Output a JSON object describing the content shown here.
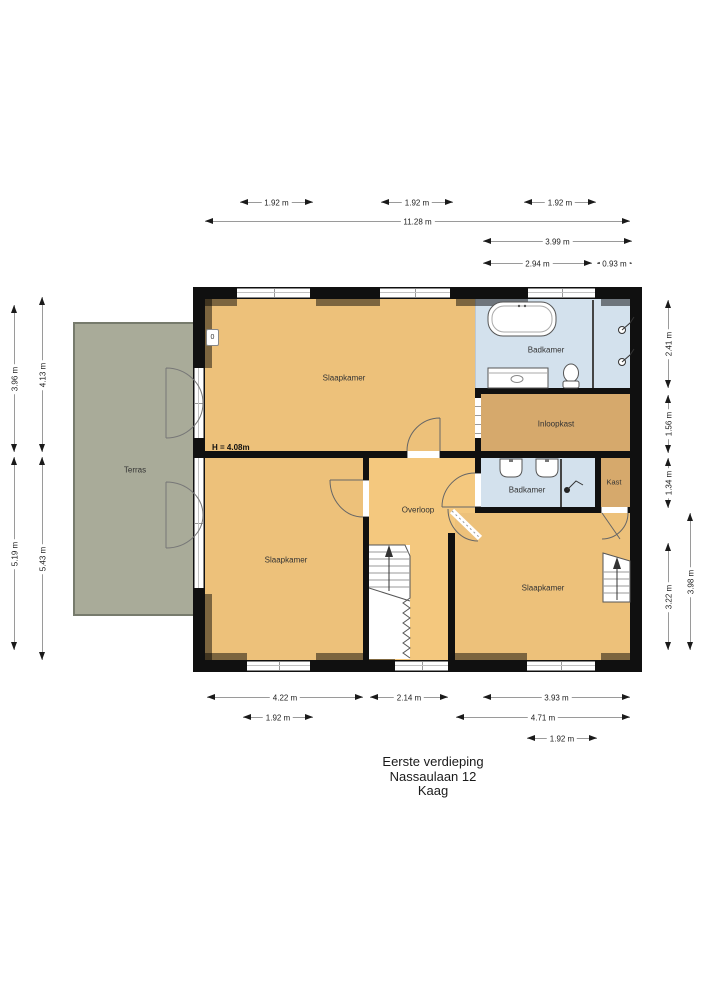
{
  "title": {
    "line1": "Eerste verdieping",
    "line2": "Nassaulaan 12",
    "line3": "Kaag"
  },
  "rooms": {
    "terras": "Terras",
    "slaapkamer_tl": "Slaapkamer",
    "badkamer_top": "Badkamer",
    "inloopkast": "Inloopkast",
    "badkamer_mid": "Badkamer",
    "kast": "Kast",
    "overloop": "Overloop",
    "slaapkamer_bl": "Slaapkamer",
    "slaapkamer_br": "Slaapkamer"
  },
  "annotations": {
    "ceiling_height": "H = 4.08m",
    "marker": "0"
  },
  "dimensions": {
    "top": [
      "1.92 m",
      "1.92 m",
      "1.92 m",
      "11.28 m",
      "3.99 m",
      "2.94 m",
      "0.93 m"
    ],
    "bottom": [
      "4.22 m",
      "2.14 m",
      "3.93 m",
      "1.92 m",
      "4.71 m",
      "1.92 m"
    ],
    "left": [
      "3.96 m",
      "4.13 m",
      "5.19 m",
      "5.43 m"
    ],
    "right": [
      "2.41 m",
      "1.56 m",
      "1.34 m",
      "3.22 m",
      "3.98 m"
    ]
  },
  "colors": {
    "wall": "#101010",
    "bedroom": "#edc17a",
    "hallway": "#f4c87e",
    "closet": "#d6a96c",
    "bathroom": "#d3e1ed",
    "terrace": "#a9ab99",
    "dimension_line": "#9a9a9a",
    "label_text": "#333333"
  }
}
